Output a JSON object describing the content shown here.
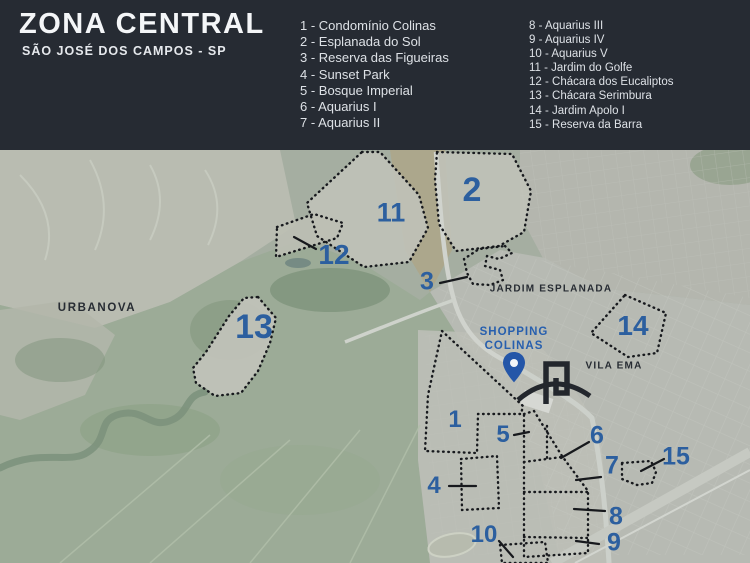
{
  "header": {
    "title": "ZONA CENTRAL",
    "subtitle": "SÃO JOSÉ DOS CAMPOS - SP",
    "legend_col1": [
      "1 - Condomínio Colinas",
      "2 - Esplanada do Sol",
      "3 - Reserva das Figueiras",
      "4 - Sunset Park",
      "5 - Bosque Imperial",
      "6 - Aquarius I",
      "7 - Aquarius II"
    ],
    "legend_col2": [
      "8 - Aquarius III",
      "9 - Aquarius IV",
      "10 - Aquarius V",
      "11 - Jardim do Golfe",
      "12 - Chácara dos Eucaliptos",
      "13 - Chácara Serimbura",
      "14 - Jardim Apolo I",
      "15 - Reserva da Barra"
    ]
  },
  "map": {
    "markers": [
      "1",
      "2",
      "3",
      "4",
      "5",
      "6",
      "7",
      "8",
      "9",
      "10",
      "11",
      "12",
      "13",
      "14",
      "15"
    ],
    "area_labels": {
      "urbanova": "URBANOVA",
      "jardim_esplanada": "JARDIM ESPLANADA",
      "vila_ema": "VILA EMA"
    },
    "poi": {
      "line1": "SHOPPING",
      "line2": "COLINAS"
    },
    "colors": {
      "header_bg": "#262b33",
      "marker_blue": "#2c5f9f",
      "poi_blue": "#275fae",
      "outline_dark": "#17191d"
    }
  }
}
